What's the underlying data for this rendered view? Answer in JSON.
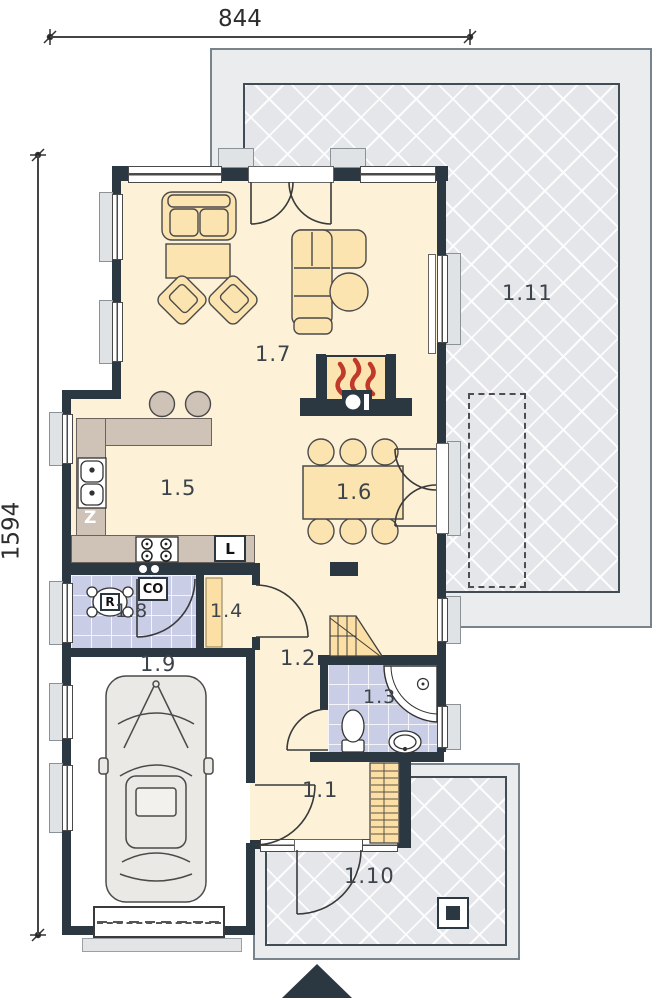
{
  "plan": {
    "dimensions": {
      "top": "844",
      "left": "1594"
    },
    "rooms": {
      "r1_1": "1.1",
      "r1_2": "1.2",
      "r1_3": "1.3",
      "r1_4": "1.4",
      "r1_5": "1.5",
      "r1_6": "1.6",
      "r1_7": "1.7",
      "r1_8": "1.8",
      "r1_9": "1.9",
      "r1_10": "1.10",
      "r1_11": "1.11"
    },
    "appliances": {
      "dishwasher": "Z",
      "fridge": "L",
      "manifold": "R",
      "boiler": "CO"
    },
    "colors": {
      "wall": "#2b3741",
      "floor": "#fdf2d8",
      "tile": "#c9cde6",
      "furniture": "#fce4b0",
      "counter": "#cfc2b6",
      "terrace": "#eaecee",
      "lattice": "#e4e6ea",
      "stairs": "#fcdfa4",
      "flame": "#bf3a2b",
      "car": "#eae9e5"
    }
  }
}
